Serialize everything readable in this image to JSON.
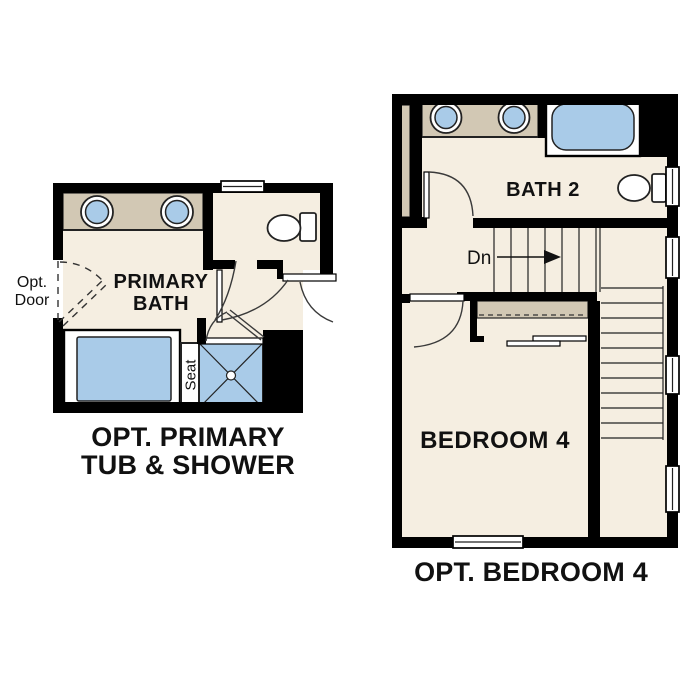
{
  "colors": {
    "bg": "#ffffff",
    "floor": "#f5eee1",
    "counter": "#d2c8b4",
    "fixture": "#a9cbe8",
    "wall": "#000000",
    "line": "#222222",
    "label": "#111111"
  },
  "plans": {
    "primary_bath": {
      "room_label_line1": "PRIMARY",
      "room_label_line2": "BATH",
      "opt_door_line1": "Opt.",
      "opt_door_line2": "Door",
      "seat_label": "Seat",
      "caption_line1": "OPT. PRIMARY",
      "caption_line2": "TUB & SHOWER"
    },
    "bedroom4": {
      "bath_label": "BATH 2",
      "stairs_label": "Dn",
      "room_label": "BEDROOM 4",
      "caption": "OPT. BEDROOM 4"
    }
  }
}
